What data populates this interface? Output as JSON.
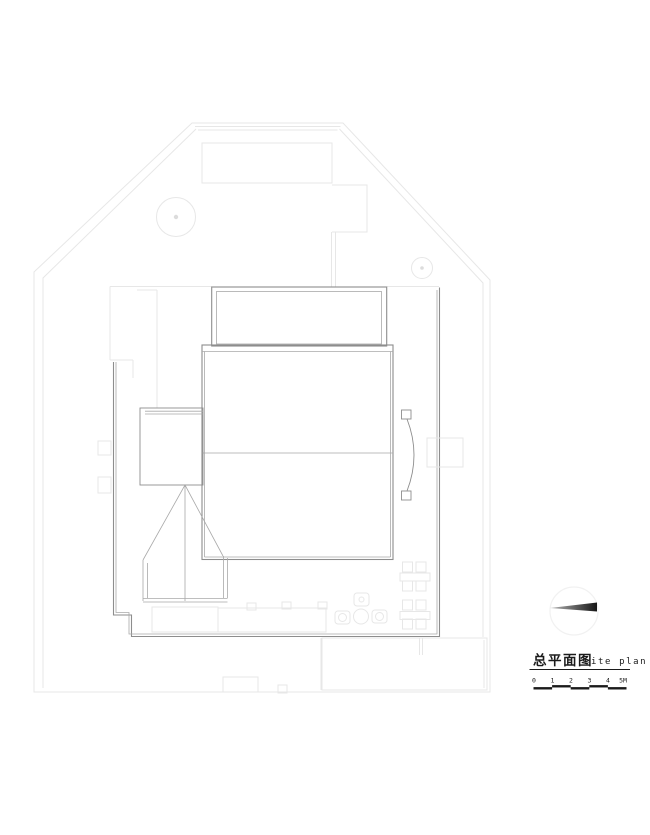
{
  "title_block": {
    "title_cn": "总平面图",
    "title_en": "site plan",
    "scale_labels": [
      "0",
      "1",
      "2",
      "3",
      "4",
      "5M"
    ]
  },
  "icons": {
    "north_arrow": "north-arrow",
    "tree": "tree-canopy-circle"
  },
  "colors": {
    "background": "#ffffff",
    "line_faint": "#e7e7e7",
    "line_light": "#dcdcdc",
    "line_medium": "#a9a9a9",
    "line_dark": "#8d8d8d",
    "text": "#1b1b1b",
    "needle_light": "#b5b5b5",
    "needle_dark": "#161616"
  }
}
